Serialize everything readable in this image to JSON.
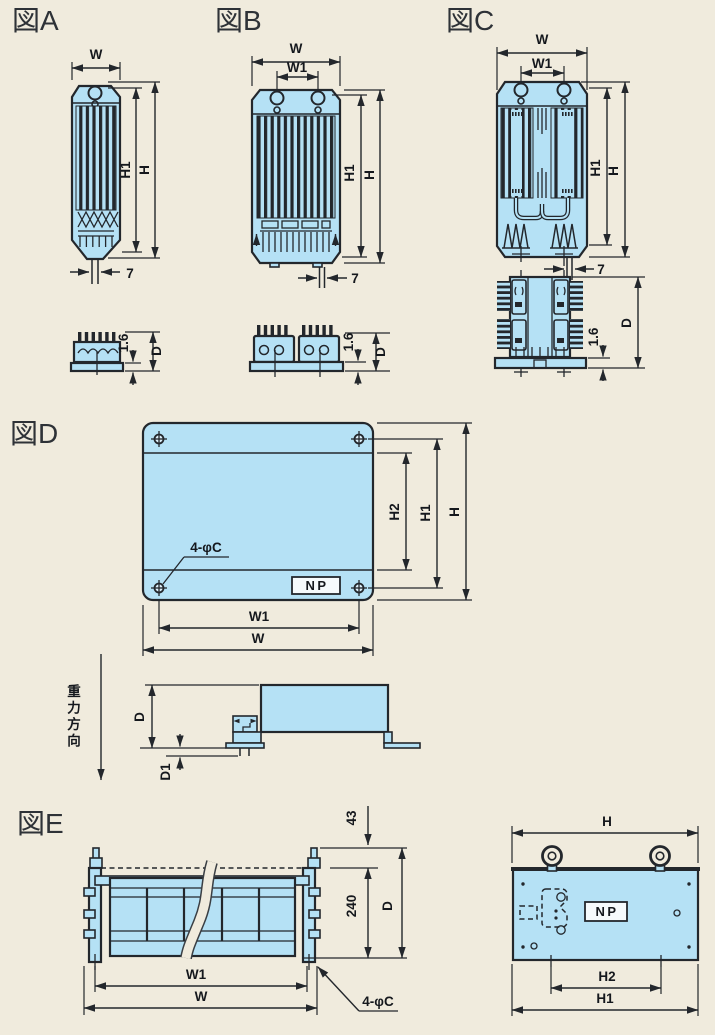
{
  "colors": {
    "background": "#f0ebdd",
    "body_fill": "#b5e1f5",
    "line": "#23272c"
  },
  "figures": {
    "a": {
      "label": "図A",
      "w": "W",
      "h1": "H1",
      "h": "H",
      "lead_pitch": "7",
      "plate_thickness": "1.6",
      "d": "D"
    },
    "b": {
      "label": "図B",
      "w": "W",
      "w1": "W1",
      "h1": "H1",
      "h": "H",
      "lead_pitch": "7",
      "plate_thickness": "1.6",
      "d": "D"
    },
    "c": {
      "label": "図C",
      "w": "W",
      "w1": "W1",
      "h1": "H1",
      "h": "H",
      "lead_pitch": "7",
      "plate_thickness": "1.6",
      "d": "D"
    },
    "d": {
      "label": "図D",
      "mounting_holes": "4-φC",
      "nameplate": "NP",
      "h2": "H2",
      "h1": "H1",
      "h": "H",
      "w1": "W1",
      "w": "W",
      "d": "D",
      "d1": "D1",
      "gravity_direction": "重力方向"
    },
    "e": {
      "label": "図E",
      "top_offset": "43",
      "element_height": "240",
      "d": "D",
      "w1": "W1",
      "w": "W",
      "mounting_holes": "4-φC",
      "h": "H",
      "nameplate": "NP",
      "h2": "H2",
      "h1": "H1"
    }
  }
}
